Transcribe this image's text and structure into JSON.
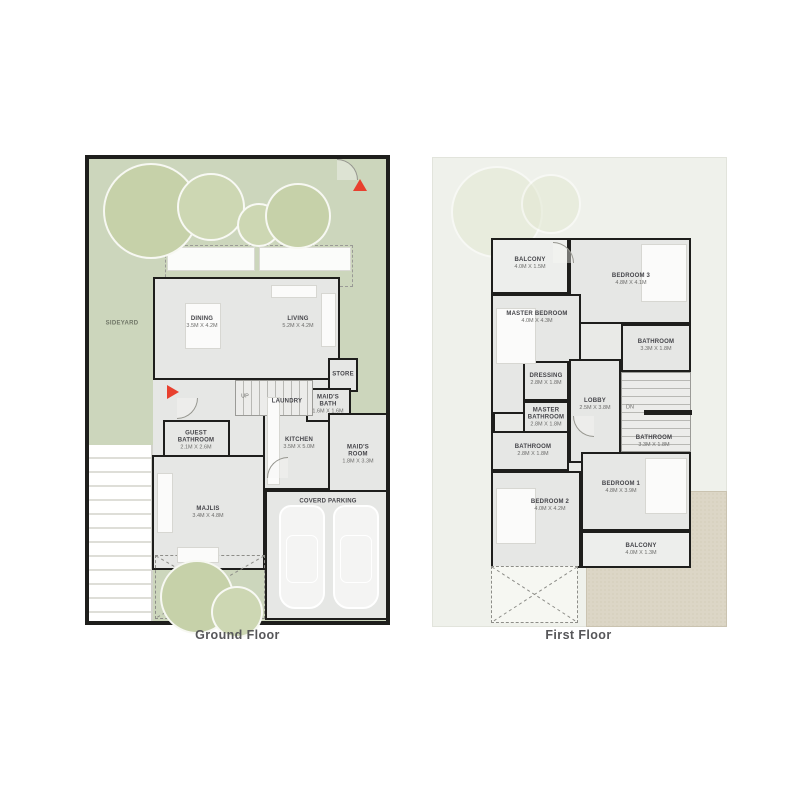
{
  "captions": {
    "ground": "Ground Floor",
    "first": "First Floor"
  },
  "colors": {
    "yard_green": "#ccd6bc",
    "tree_green": "#c6d1a9",
    "wall_black": "#1e1e1c",
    "floor_gray": "#e6e7e5",
    "first_floor_bg": "#eff1eb",
    "terrace_tan": "#dcd6c6",
    "arrow_red": "#e8402e"
  },
  "ground": {
    "yard": {
      "backyard": "BACKYARD",
      "sideyard": "SIDEYARD"
    },
    "stairs": "UP",
    "rooms": {
      "dining": {
        "name": "DINING",
        "dims": "3.5M X 4.2M"
      },
      "living": {
        "name": "LIVING",
        "dims": "5.2M X 4.2M"
      },
      "store": {
        "name": "STORE",
        "dims": ""
      },
      "laundry": {
        "name": "LAUNDRY",
        "dims": ""
      },
      "maids_bath": {
        "name": "MAID'S BATH",
        "dims": "1.6M X 1.6M"
      },
      "guest_bathroom": {
        "name": "GUEST BATHROOM",
        "dims": "2.1M X 2.6M"
      },
      "kitchen": {
        "name": "KITCHEN",
        "dims": "3.5M X 5.0M"
      },
      "maids_room": {
        "name": "MAID'S ROOM",
        "dims": "1.8M X 3.3M"
      },
      "majlis": {
        "name": "MAJLIS",
        "dims": "3.4M X 4.8M"
      },
      "parking": {
        "name": "COVERD PARKING",
        "dims": ""
      }
    }
  },
  "first": {
    "stairs": "DN",
    "rooms": {
      "balcony_top": {
        "name": "BALCONY",
        "dims": "4.0M X 1.5M"
      },
      "bedroom3": {
        "name": "BEDROOM 3",
        "dims": "4.8M X 4.1M"
      },
      "master_bedroom": {
        "name": "MASTER BEDROOM",
        "dims": "4.0M X 4.3M"
      },
      "bathroom_top": {
        "name": "BATHROOM",
        "dims": "3.3M X 1.8M"
      },
      "dressing": {
        "name": "DRESSING",
        "dims": "2.8M X 1.8M"
      },
      "master_bathroom": {
        "name": "MASTER BATHROOM",
        "dims": "2.8M X 1.8M"
      },
      "lobby": {
        "name": "LOBBY",
        "dims": "2.5M X 3.8M"
      },
      "bathroom_left": {
        "name": "BATHROOM",
        "dims": "2.8M X 1.8M"
      },
      "bathroom_right": {
        "name": "BATHROOM",
        "dims": "3.3M X 1.8M"
      },
      "bedroom2": {
        "name": "BEDROOM 2",
        "dims": "4.0M X 4.2M"
      },
      "bedroom1": {
        "name": "BEDROOM 1",
        "dims": "4.8M X 3.9M"
      },
      "balcony_bottom": {
        "name": "BALCONY",
        "dims": "4.0M X 1.3M"
      }
    }
  }
}
